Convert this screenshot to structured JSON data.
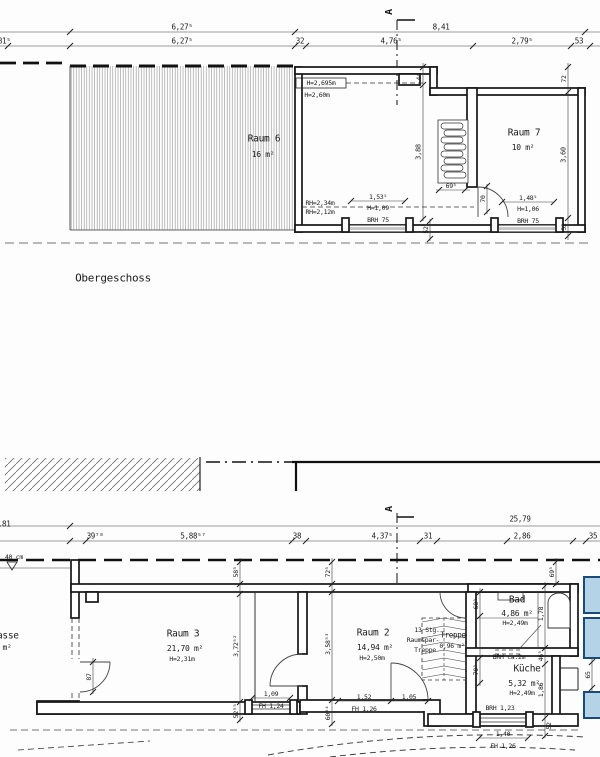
{
  "colors": {
    "line": "#1b1b1b",
    "neighbor_fill": "#b5d3e7",
    "neighbor_stroke": "#1a4a78",
    "hatch": "#8a8a8a"
  },
  "floors": {
    "upper_title": "Obergeschoss",
    "upper_rooms": [
      {
        "name": "Raum 6",
        "area": "16 m²"
      },
      {
        "name": "Raum 7",
        "area": "10 m²"
      }
    ],
    "lower_rooms": [
      {
        "name": "Terrasse",
        "area": "m²"
      },
      {
        "name": "Raum 3",
        "area": "21,70 m²",
        "height": "H=2,31m"
      },
      {
        "name": "Raum 2",
        "area": "14,94 m²",
        "height": "H=2,50m"
      },
      {
        "name": "Bad",
        "area": "4,86 m²",
        "height": "H=2,49m"
      },
      {
        "name": "Küche",
        "area": "5,32 m²",
        "height": "H=2,49m"
      },
      {
        "name": "Treppe",
        "area": "0,96 m²",
        "note": "13 Stg. Raumspar-Treppe"
      }
    ]
  },
  "labels": [
    {
      "t": "6,27⁵",
      "x": 182,
      "y": 27
    },
    {
      "t": "8,41",
      "x": 441,
      "y": 27
    },
    {
      "t": "1,81⁵",
      "x": 0,
      "y": 41
    },
    {
      "t": "6,27⁵",
      "x": 182,
      "y": 41
    },
    {
      "t": "32",
      "x": 300,
      "y": 41
    },
    {
      "t": "4,76⁵",
      "x": 391,
      "y": 41
    },
    {
      "t": "2,79⁵",
      "x": 522,
      "y": 41
    },
    {
      "t": "53",
      "x": 579,
      "y": 41
    },
    {
      "t": "A",
      "x": 390,
      "y": 12,
      "r": 1,
      "s": 10,
      "b": 1,
      "n": "section-marker-a-top"
    },
    {
      "t": "H=2,695m",
      "x": 321,
      "y": 83,
      "s": 6.5,
      "n": "height-note"
    },
    {
      "t": "H=2,60m",
      "x": 317,
      "y": 95,
      "s": 6.5,
      "n": "height-note"
    },
    {
      "t": "44",
      "x": 419,
      "y": 77,
      "r": 1,
      "s": 6.5
    },
    {
      "t": "3,88",
      "x": 419,
      "y": 152,
      "r": 1,
      "s": 7
    },
    {
      "t": "Raum 6",
      "x": 264,
      "y": 139,
      "s": 9.5,
      "n": "room-name-raum6"
    },
    {
      "t": "16 m²",
      "x": 263,
      "y": 155,
      "s": 8,
      "n": "room-area-raum6"
    },
    {
      "t": "Raum 7",
      "x": 524,
      "y": 133,
      "s": 9.5,
      "n": "room-name-raum7"
    },
    {
      "t": "10 m²",
      "x": 523,
      "y": 148,
      "s": 8,
      "n": "room-area-raum7"
    },
    {
      "t": "72",
      "x": 564,
      "y": 79,
      "r": 1,
      "s": 6.5
    },
    {
      "t": "3,60",
      "x": 564,
      "y": 155,
      "r": 1,
      "s": 7
    },
    {
      "t": "52",
      "x": 564,
      "y": 227,
      "r": 1,
      "s": 6.5
    },
    {
      "t": "52",
      "x": 426,
      "y": 230,
      "r": 1,
      "s": 6.5
    },
    {
      "t": "69⁵",
      "x": 451,
      "y": 186,
      "s": 6.5
    },
    {
      "t": "70",
      "x": 483,
      "y": 199,
      "r": 1,
      "s": 6.5
    },
    {
      "t": "1,48⁵",
      "x": 528,
      "y": 198,
      "s": 6.5
    },
    {
      "t": "H=1,06",
      "x": 528,
      "y": 209,
      "s": 6.5
    },
    {
      "t": "BRH 75",
      "x": 528,
      "y": 221,
      "s": 6.5
    },
    {
      "t": "1,53⁵",
      "x": 378,
      "y": 197,
      "s": 6.5
    },
    {
      "t": "H=1,09",
      "x": 378,
      "y": 208,
      "s": 6.5
    },
    {
      "t": "BRH 75",
      "x": 378,
      "y": 220,
      "s": 6.5
    },
    {
      "t": "RH=2,34m",
      "x": 320,
      "y": 203,
      "s": 6.5
    },
    {
      "t": "RH=2,12m",
      "x": 320,
      "y": 212,
      "s": 6.5
    },
    {
      "t": "Obergeschoss",
      "x": 113,
      "y": 278,
      "s": 11,
      "n": "floor-title"
    },
    {
      "t": "A",
      "x": 390,
      "y": 509,
      "r": 1,
      "s": 10,
      "b": 1,
      "n": "section-marker-a-bottom"
    },
    {
      "t": "1,81",
      "x": 2,
      "y": 524
    },
    {
      "t": "25,79",
      "x": 520,
      "y": 519
    },
    {
      "t": "39⁷⁸",
      "x": 95,
      "y": 536
    },
    {
      "t": "5,88⁵⁷",
      "x": 193,
      "y": 536
    },
    {
      "t": "38",
      "x": 297,
      "y": 536
    },
    {
      "t": "4,37⁵",
      "x": 382,
      "y": 536
    },
    {
      "t": "31",
      "x": 428,
      "y": 536
    },
    {
      "t": "2,86",
      "x": 522,
      "y": 536
    },
    {
      "t": "35",
      "x": 593,
      "y": 536
    },
    {
      "t": "40 cm",
      "x": 14,
      "y": 557,
      "s": 6.5,
      "n": "level-note"
    },
    {
      "t": "Terrasse",
      "x": -3,
      "y": 636,
      "s": 9.5,
      "n": "room-name-terrasse"
    },
    {
      "t": "m²",
      "x": 7,
      "y": 648,
      "s": 8,
      "n": "room-area-terrasse"
    },
    {
      "t": "58⁵",
      "x": 236,
      "y": 572,
      "r": 1,
      "s": 6.5
    },
    {
      "t": "72⁵",
      "x": 328,
      "y": 572,
      "r": 1,
      "s": 6.5
    },
    {
      "t": "69⁵",
      "x": 552,
      "y": 572,
      "r": 1,
      "s": 6.5
    },
    {
      "t": "Raum 3",
      "x": 183,
      "y": 634,
      "s": 9.5,
      "n": "room-name-raum3"
    },
    {
      "t": "21,70 m²",
      "x": 185,
      "y": 649,
      "s": 8,
      "n": "room-area-raum3"
    },
    {
      "t": "H=2,31m",
      "x": 182,
      "y": 659,
      "s": 6.5
    },
    {
      "t": "3,72⁵²",
      "x": 236,
      "y": 646,
      "r": 1,
      "s": 6.5
    },
    {
      "t": "87",
      "x": 89,
      "y": 677,
      "r": 1,
      "s": 6.5
    },
    {
      "t": "1,09",
      "x": 271,
      "y": 694,
      "s": 6.5
    },
    {
      "t": "FH 1,24",
      "x": 271,
      "y": 706,
      "s": 6.5
    },
    {
      "t": "52⁵⁵",
      "x": 236,
      "y": 711,
      "r": 1,
      "s": 6.5
    },
    {
      "t": "Raum 2",
      "x": 373,
      "y": 633,
      "s": 9.5,
      "n": "room-name-raum2"
    },
    {
      "t": "14,94 m²",
      "x": 375,
      "y": 648,
      "s": 8,
      "n": "room-area-raum2"
    },
    {
      "t": "H=2,50m",
      "x": 372,
      "y": 658,
      "s": 6.5
    },
    {
      "t": "3,58⁵³",
      "x": 328,
      "y": 644,
      "r": 1,
      "s": 6.5
    },
    {
      "t": "1,52",
      "x": 364,
      "y": 697,
      "s": 6.5
    },
    {
      "t": "FH 1,26",
      "x": 364,
      "y": 709,
      "s": 6.5
    },
    {
      "t": "1,05",
      "x": 409,
      "y": 697,
      "s": 6.5
    },
    {
      "t": "60⁶⁴",
      "x": 328,
      "y": 713,
      "r": 1,
      "s": 6.5
    },
    {
      "t": "13 Stg.",
      "x": 427,
      "y": 630,
      "s": 6.5,
      "n": "stair-note"
    },
    {
      "t": "Raumspar-",
      "x": 423,
      "y": 640,
      "s": 6.5,
      "n": "stair-note"
    },
    {
      "t": "Treppe",
      "x": 425,
      "y": 650,
      "s": 6.5,
      "n": "stair-note"
    },
    {
      "t": "Treppe",
      "x": 453,
      "y": 635,
      "s": 7.5,
      "n": "stair-label"
    },
    {
      "t": "0,96 m²",
      "x": 452,
      "y": 646,
      "s": 6.5,
      "n": "stair-area"
    },
    {
      "t": "Bad",
      "x": 517,
      "y": 600,
      "s": 9.5,
      "n": "room-name-bad"
    },
    {
      "t": "4,86 m²",
      "x": 517,
      "y": 614,
      "s": 8,
      "n": "room-area-bad"
    },
    {
      "t": "H=2,49m",
      "x": 515,
      "y": 623,
      "s": 6.5
    },
    {
      "t": "68⁵",
      "x": 476,
      "y": 604,
      "r": 1,
      "s": 6.5
    },
    {
      "t": "1,78",
      "x": 541,
      "y": 614,
      "r": 1,
      "s": 6.5
    },
    {
      "t": "46⁵",
      "x": 541,
      "y": 656,
      "r": 1,
      "s": 6.5
    },
    {
      "t": "BRH ca.2m",
      "x": 509,
      "y": 657,
      "s": 6.5,
      "n": "sill-note"
    },
    {
      "t": "Küche",
      "x": 527,
      "y": 669,
      "s": 9.5,
      "n": "room-name-kueche"
    },
    {
      "t": "5,32 m²",
      "x": 524,
      "y": 684,
      "s": 8,
      "n": "room-area-kueche"
    },
    {
      "t": "H=2,49m",
      "x": 522,
      "y": 693,
      "s": 6.5
    },
    {
      "t": "70⁵",
      "x": 476,
      "y": 670,
      "r": 1,
      "s": 6.5
    },
    {
      "t": "1,86",
      "x": 541,
      "y": 690,
      "r": 1,
      "s": 6.5
    },
    {
      "t": "BRH 1,23",
      "x": 500,
      "y": 708,
      "s": 6.5,
      "n": "sill-note"
    },
    {
      "t": "1,40",
      "x": 503,
      "y": 734,
      "s": 6.5
    },
    {
      "t": "FH 1,26",
      "x": 503,
      "y": 746,
      "s": 6.5
    },
    {
      "t": "52",
      "x": 549,
      "y": 726,
      "r": 1,
      "s": 6.5
    },
    {
      "t": "65",
      "x": 588,
      "y": 675,
      "r": 1,
      "s": 6.5
    }
  ]
}
